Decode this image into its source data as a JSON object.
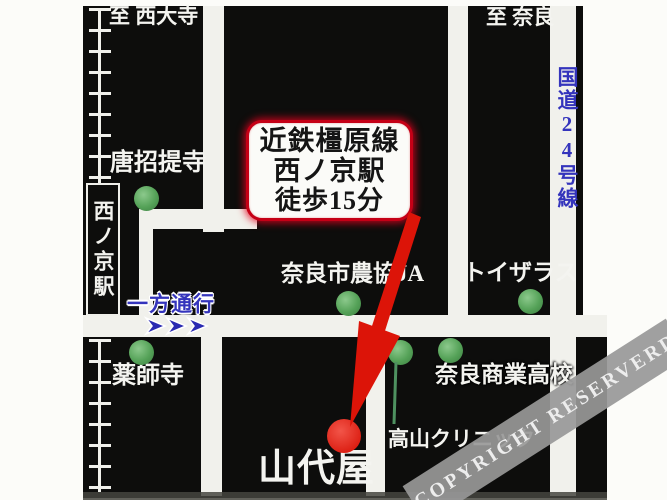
{
  "top_labels": {
    "to_saidaiji": "至 西大寺",
    "to_nara": "至 奈良"
  },
  "roads": {
    "route24": "国道24号線",
    "one_way": "一方通行"
  },
  "station": {
    "name": "西ノ京駅"
  },
  "callout": {
    "line1": "近鉄橿原線",
    "line2": "西ノ京駅",
    "line3": "徒歩15分"
  },
  "landmarks": {
    "toshodaiji": "唐招提寺",
    "yakushiji": "薬師寺",
    "ja_coop": "奈良市農協JA",
    "toys_r_us": "トイザラス",
    "commercial_high_school": "奈良商業高校",
    "clinic": "高山クリニック"
  },
  "destination": "山代屋",
  "watermark": "COPYRIGHT RESERVERD",
  "colors": {
    "panel_black": "#0d0d0c",
    "road_white": "#f1f1ec",
    "arrow_red": "#dc1408",
    "marker_red": "#dc1e12",
    "landmark_green": "#55a258",
    "info_blue": "#3434bc",
    "callout_border_red": "#c50016",
    "watermark_gray": "#989898"
  }
}
